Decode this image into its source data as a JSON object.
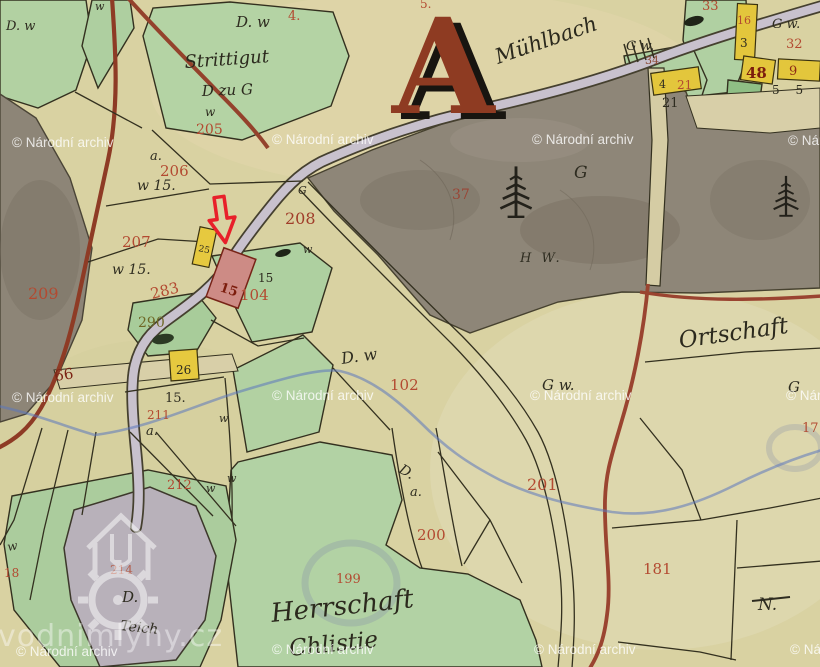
{
  "watermarks": {
    "archive": "© Národní archiv",
    "site": "vodnimlyny.cz"
  },
  "annotations": {
    "section_letter": "A"
  },
  "toponyms": {
    "stream": "Mühlbach",
    "village": "Ortschaft",
    "estate_line1": "Herrschaft",
    "estate_line2": "Chlistie",
    "pond_type": "Teich",
    "strittigut": "Strittigut",
    "d_zu_g": "D zu G",
    "forest_mark": "H W."
  },
  "parcel_numbers": {
    "n4": "4.",
    "n5": "5.",
    "n205": "205",
    "n206": "206",
    "n207": "207",
    "n208": "208",
    "n209": "209",
    "n283": "283",
    "n290": "290",
    "n104": "104",
    "n102": "102",
    "n201": "201",
    "n200": "200",
    "n199": "199",
    "n211": "211",
    "n212": "212",
    "n214": "214",
    "n181": "181",
    "n37": "37",
    "n33": "33",
    "n32": "32",
    "n16": "16",
    "n21": "21",
    "n34": "34",
    "n48": "48",
    "n9": "9",
    "n17": "17",
    "n18": "18",
    "n15_mill": "15",
    "n66": "66"
  },
  "field_letters": {
    "g": "G",
    "g_w": "G w.",
    "d_w": "D. w",
    "d": "D.",
    "a": "a.",
    "w": "w",
    "w_15": "w 15.",
    "n15": "15",
    "n15dot": "15.",
    "n21b": "21",
    "n25": "25",
    "n26": "26",
    "n3": "3",
    "n4b": "4",
    "n5_5": "5 5",
    "n_mark": "N."
  }
}
